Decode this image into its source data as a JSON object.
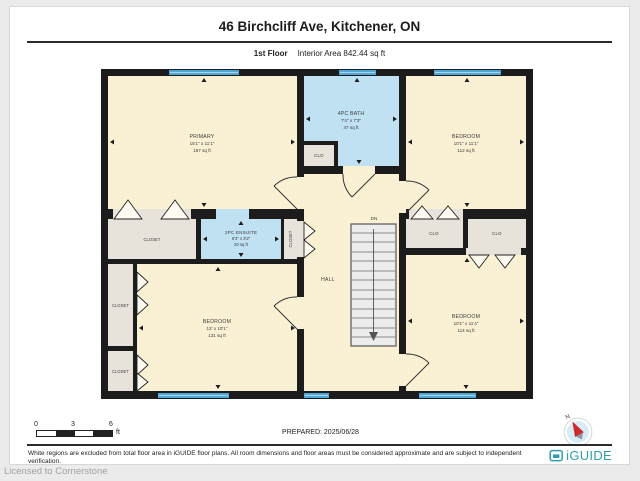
{
  "header": {
    "title": "46 Birchcliff Ave, Kitchener, ON",
    "floor": "1st Floor",
    "interior_area": "Interior Area 842.44 sq ft"
  },
  "plan": {
    "rooms": {
      "primary": {
        "name": "PRIMARY",
        "dims": "15'1\" x 11'1\"",
        "area": "167 sq ft"
      },
      "bath": {
        "name": "4PC BATH",
        "dims": "7'4\" x 7'3\"",
        "area": "47 sq ft"
      },
      "bedroom_top_right": {
        "name": "BEDROOM",
        "dims": "10'1\" x 11'1\"",
        "area": "112 sq ft"
      },
      "ensuite": {
        "name": "2PC ENSUITE",
        "dims": "6'3\" x 3'2\"",
        "area": "20 sq ft"
      },
      "bedroom_bottom_left": {
        "name": "BEDROOM",
        "dims": "13' x 10'1\"",
        "area": "131 sq ft"
      },
      "bedroom_bottom_right": {
        "name": "BEDROOM",
        "dims": "10'1\" x 11'4\"",
        "area": "114 sq ft"
      },
      "hall": "HALL",
      "stairs_direction": "DN",
      "closet_full": "CLOSET",
      "closet_abbr": "CLO"
    }
  },
  "footer": {
    "scale": {
      "t0": "0",
      "t3": "3",
      "t6": "6",
      "unit": "ft"
    },
    "prepared": "PREPARED: 2025/06/28",
    "compass_north": "N",
    "disclaimer": "White regions are excluded from total floor area in iGUIDE floor plans. All room dimensions and floor areas must be considered approximate and are subject to independent verification.",
    "brand": "iGUIDE"
  },
  "watermark": "Licensed to Cornerstone",
  "colors": {
    "wall": "#1c1c1c",
    "room": "#faf1d4",
    "wet": "#bfe1f1",
    "closet": "#e7e3da",
    "window": "#4fa7d6",
    "brand": "#2f9daa"
  }
}
